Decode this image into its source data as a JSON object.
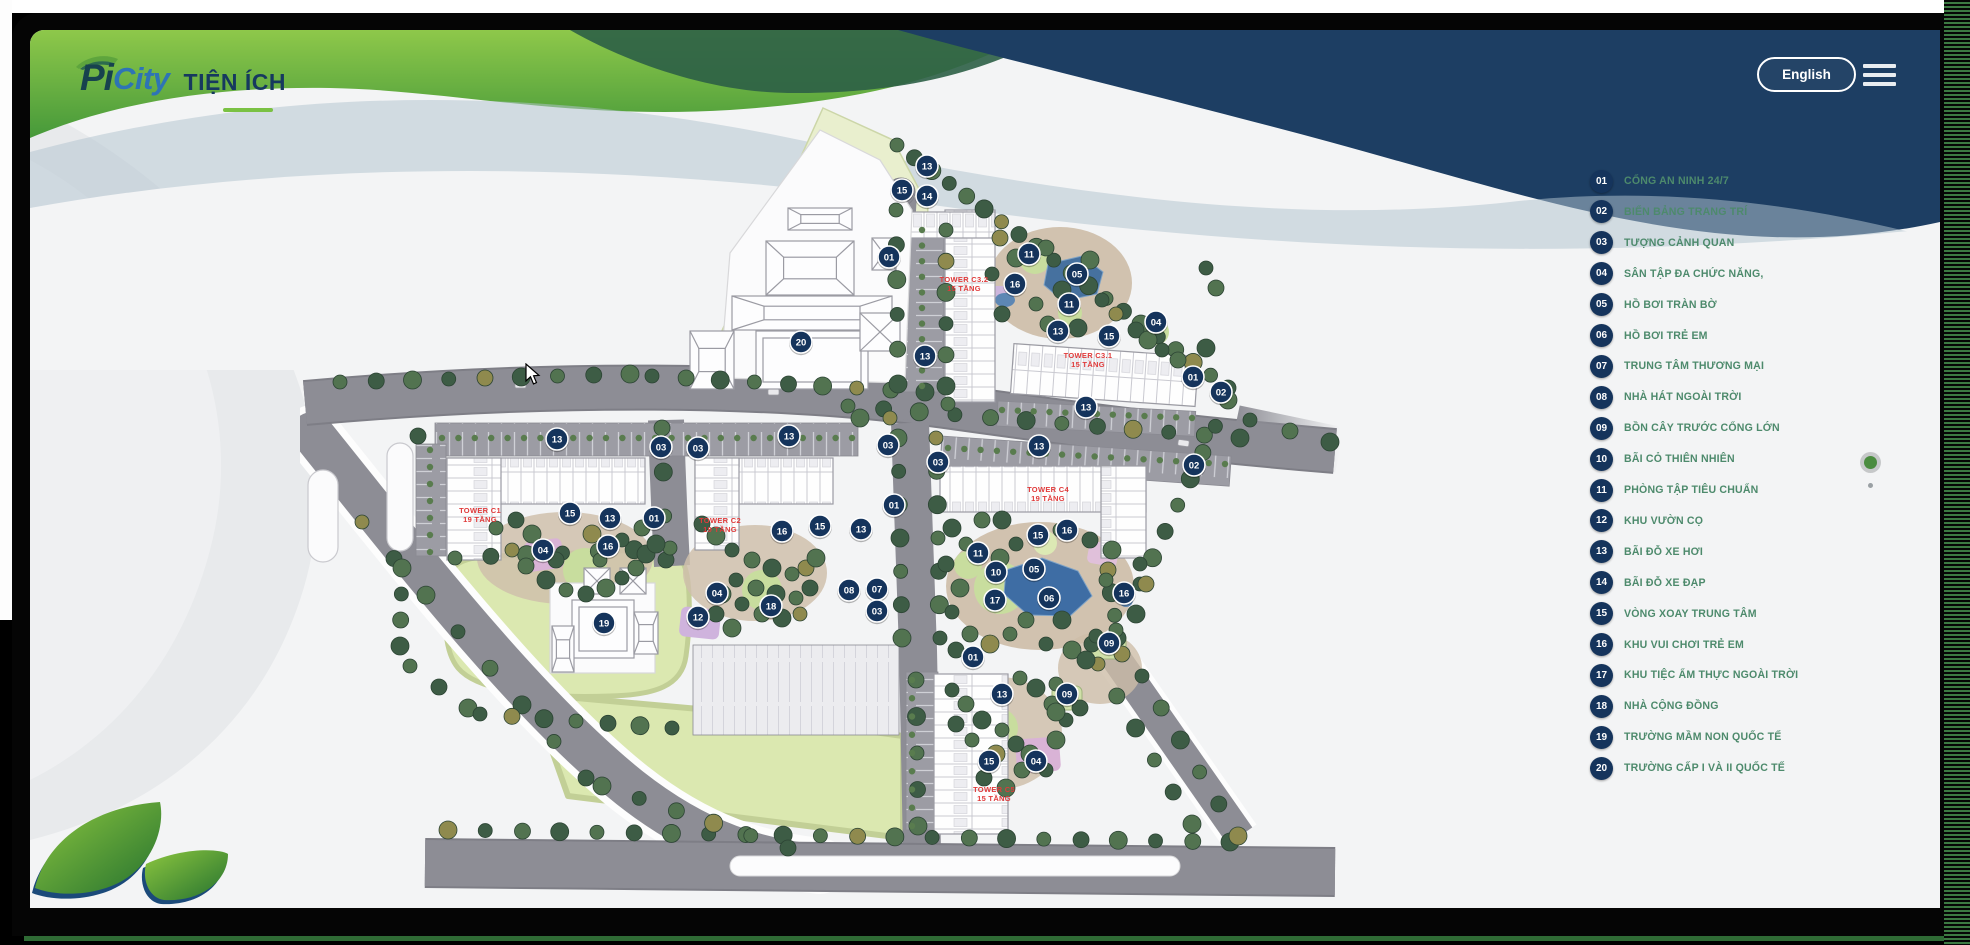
{
  "header": {
    "logo_pi": "Pi",
    "logo_city": "City",
    "page_title": "TIỆN ÍCH",
    "language_button": "English"
  },
  "legend": {
    "text_color": "#4d8a6c",
    "badge_color": "#15345c",
    "items": [
      {
        "num": "01",
        "label": "CỔNG AN NINH 24/7"
      },
      {
        "num": "02",
        "label": "BIỂN BẢNG TRANG TRÍ"
      },
      {
        "num": "03",
        "label": "TƯỢNG CẢNH QUAN"
      },
      {
        "num": "04",
        "label": "SÂN TẬP ĐA CHỨC NĂNG,"
      },
      {
        "num": "05",
        "label": "HỒ BƠI TRÀN BỜ"
      },
      {
        "num": "06",
        "label": "HỒ BƠI TRẺ EM"
      },
      {
        "num": "07",
        "label": "TRUNG TÂM THƯƠNG MẠI"
      },
      {
        "num": "08",
        "label": "NHÀ HÁT NGOÀI TRỜI"
      },
      {
        "num": "09",
        "label": "BỒN CÂY TRƯỚC CỔNG LỚN"
      },
      {
        "num": "10",
        "label": "BÃI CỎ THIÊN NHIÊN"
      },
      {
        "num": "11",
        "label": "PHÒNG TẬP TIÊU CHUẨN"
      },
      {
        "num": "12",
        "label": "KHU VƯỜN CỌ"
      },
      {
        "num": "13",
        "label": "BÃI ĐỖ XE HƠI"
      },
      {
        "num": "14",
        "label": "BÃI ĐỖ XE ĐẠP"
      },
      {
        "num": "15",
        "label": "VÒNG XOAY TRUNG TÂM"
      },
      {
        "num": "16",
        "label": "KHU VUI CHƠI TRẺ EM"
      },
      {
        "num": "17",
        "label": "KHU TIỆC ẨM THỰC NGOÀI TRỜI"
      },
      {
        "num": "18",
        "label": "NHÀ CỘNG ĐỒNG"
      },
      {
        "num": "19",
        "label": "TRƯỜNG MẦM NON QUỐC TẾ"
      },
      {
        "num": "20",
        "label": "TRƯỜNG CẤP I VÀ II QUỐC TẾ"
      }
    ]
  },
  "map": {
    "colors": {
      "marker": "#15345c",
      "marker_text": "#ffffff",
      "tower_label": "#e03a3a",
      "navy": "#1d3e63",
      "green": "#6db33f",
      "road": "#8d8d95",
      "lawn": "#dbe8b0",
      "pool": "#3e6da4"
    },
    "tower_labels": [
      {
        "name": "TOWER C3.2",
        "floors": "15 TẦNG",
        "x": 664,
        "y": 194
      },
      {
        "name": "TOWER C3.1",
        "floors": "15 TẦNG",
        "x": 788,
        "y": 270
      },
      {
        "name": "TOWER C1",
        "floors": "19 TẦNG",
        "x": 180,
        "y": 425
      },
      {
        "name": "TOWER C2",
        "floors": "19 TẦNG",
        "x": 420,
        "y": 435
      },
      {
        "name": "TOWER C4",
        "floors": "19 TẦNG",
        "x": 748,
        "y": 404
      },
      {
        "name": "TOWER C5",
        "floors": "15 TẦNG",
        "x": 694,
        "y": 704
      }
    ],
    "markers": [
      {
        "n": "13",
        "x": 627,
        "y": 78
      },
      {
        "n": "15",
        "x": 602,
        "y": 102
      },
      {
        "n": "14",
        "x": 627,
        "y": 108
      },
      {
        "n": "01",
        "x": 589,
        "y": 169
      },
      {
        "n": "20",
        "x": 501,
        "y": 254
      },
      {
        "n": "13",
        "x": 625,
        "y": 268
      },
      {
        "n": "11",
        "x": 729,
        "y": 166
      },
      {
        "n": "16",
        "x": 715,
        "y": 196
      },
      {
        "n": "05",
        "x": 777,
        "y": 186
      },
      {
        "n": "11",
        "x": 769,
        "y": 216
      },
      {
        "n": "04",
        "x": 856,
        "y": 234
      },
      {
        "n": "13",
        "x": 758,
        "y": 243
      },
      {
        "n": "15",
        "x": 809,
        "y": 248
      },
      {
        "n": "01",
        "x": 893,
        "y": 289
      },
      {
        "n": "02",
        "x": 921,
        "y": 304
      },
      {
        "n": "13",
        "x": 786,
        "y": 319
      },
      {
        "n": "13",
        "x": 489,
        "y": 348
      },
      {
        "n": "03",
        "x": 588,
        "y": 357
      },
      {
        "n": "03",
        "x": 638,
        "y": 374
      },
      {
        "n": "13",
        "x": 739,
        "y": 358
      },
      {
        "n": "02",
        "x": 894,
        "y": 377
      },
      {
        "n": "01",
        "x": 594,
        "y": 417
      },
      {
        "n": "13",
        "x": 561,
        "y": 441
      },
      {
        "n": "15",
        "x": 738,
        "y": 447
      },
      {
        "n": "16",
        "x": 767,
        "y": 442
      },
      {
        "n": "11",
        "x": 678,
        "y": 465
      },
      {
        "n": "10",
        "x": 696,
        "y": 484
      },
      {
        "n": "05",
        "x": 734,
        "y": 481
      },
      {
        "n": "17",
        "x": 695,
        "y": 512
      },
      {
        "n": "06",
        "x": 749,
        "y": 510
      },
      {
        "n": "16",
        "x": 824,
        "y": 505
      },
      {
        "n": "08",
        "x": 549,
        "y": 502
      },
      {
        "n": "07",
        "x": 577,
        "y": 501
      },
      {
        "n": "03",
        "x": 577,
        "y": 523
      },
      {
        "n": "09",
        "x": 809,
        "y": 555
      },
      {
        "n": "01",
        "x": 673,
        "y": 569
      },
      {
        "n": "13",
        "x": 702,
        "y": 606
      },
      {
        "n": "09",
        "x": 767,
        "y": 606
      },
      {
        "n": "15",
        "x": 689,
        "y": 673
      },
      {
        "n": "04",
        "x": 736,
        "y": 673
      },
      {
        "n": "13",
        "x": 257,
        "y": 351
      },
      {
        "n": "03",
        "x": 361,
        "y": 359
      },
      {
        "n": "03",
        "x": 398,
        "y": 360
      },
      {
        "n": "15",
        "x": 270,
        "y": 425
      },
      {
        "n": "13",
        "x": 310,
        "y": 430
      },
      {
        "n": "01",
        "x": 354,
        "y": 430
      },
      {
        "n": "16",
        "x": 308,
        "y": 458
      },
      {
        "n": "04",
        "x": 243,
        "y": 462
      },
      {
        "n": "16",
        "x": 482,
        "y": 443
      },
      {
        "n": "15",
        "x": 520,
        "y": 438
      },
      {
        "n": "04",
        "x": 417,
        "y": 505
      },
      {
        "n": "12",
        "x": 398,
        "y": 529
      },
      {
        "n": "18",
        "x": 471,
        "y": 518
      },
      {
        "n": "19",
        "x": 304,
        "y": 535
      }
    ]
  }
}
